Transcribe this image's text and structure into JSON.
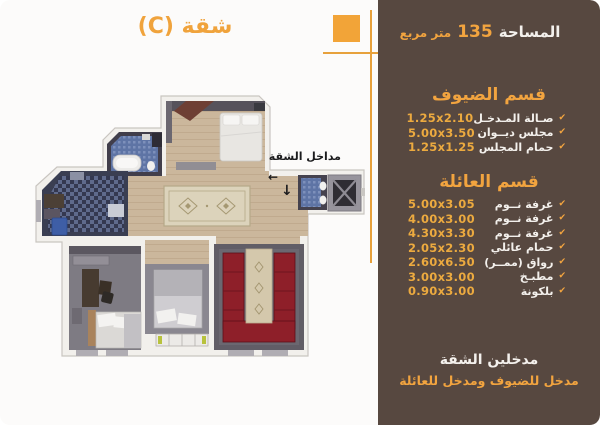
{
  "title": "شقة (C)",
  "area": {
    "label": "المساحة",
    "value": "135",
    "unit": "متر مربع"
  },
  "sections": [
    {
      "title": "قسم الضيوف",
      "rows": [
        {
          "name": "صـالة المـدخـل",
          "dim": "1.25x2.10"
        },
        {
          "name": "مجلس ديــوان",
          "dim": "5.00x3.50"
        },
        {
          "name": "حمام المجلس",
          "dim": "1.25x1.25"
        }
      ]
    },
    {
      "title": "قسم العائلة",
      "rows": [
        {
          "name": "غرفة نــوم",
          "dim": "5.00x3.05"
        },
        {
          "name": "غرفة نــوم",
          "dim": "4.00x3.00"
        },
        {
          "name": "غرفة نــوم",
          "dim": "4.30x3.30"
        },
        {
          "name": "حمام عائلي",
          "dim": "2.05x2.30"
        },
        {
          "name": "رواق (ممــر)",
          "dim": "2.60x6.50"
        },
        {
          "name": "مطبـخ",
          "dim": "3.00x3.00"
        },
        {
          "name": "بلكونة",
          "dim": "0.90x3.00"
        }
      ]
    }
  ],
  "footer": {
    "line1": "مدخلين الشقة",
    "line2": "مدخل للضيوف ومدخل للعائلة"
  },
  "plan": {
    "entrance_label": "مداخل الشقة",
    "arrow_left": "←",
    "arrow_down": "↓"
  },
  "icons": {
    "check": "✔"
  },
  "colors": {
    "panel_brown": "#574840",
    "accent_orange": "#f2a43f",
    "dim_orange": "#ecaa3f",
    "text_white": "#f3f0ec",
    "majlis_red": "#8e1f29",
    "wood_floor": "#cbb79c",
    "tile_blue": "#5e74a5",
    "gray_floor": "#7e7b83"
  }
}
